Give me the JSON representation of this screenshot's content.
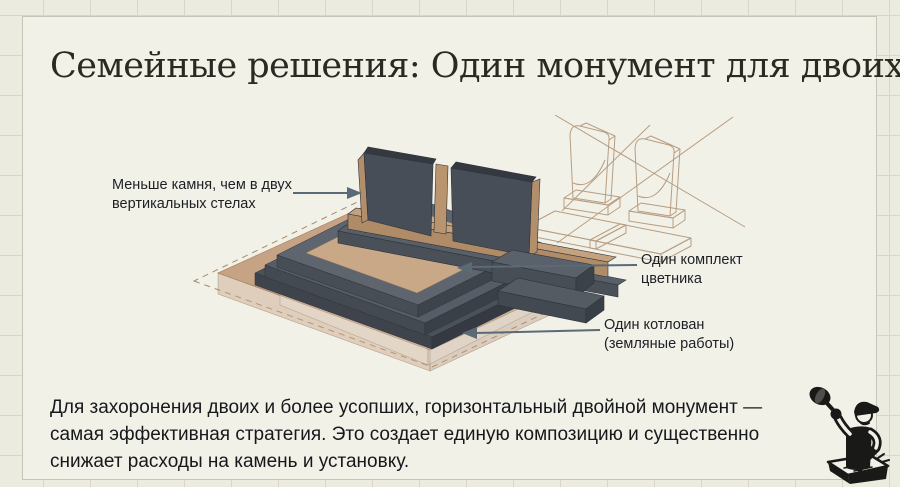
{
  "slide": {
    "title": "Семейные решения: Один монумент для двоих",
    "paragraph_lines": [
      "Для захоронения двоих и более усопших, горизонтальный двойной монумент —",
      "самая эффективная стратегия. Это создает единую композицию и существенно",
      "снижает расходы на камень и установку."
    ]
  },
  "annotations": {
    "less_stone": {
      "line1": "Меньше камня, чем в двух",
      "line2": "вертикальных стелах"
    },
    "flowerbed": {
      "line1": "Один комплект",
      "line2": "цветника"
    },
    "pit": {
      "line1": "Один котлован",
      "line2": "(земляные работы)"
    }
  },
  "icons": {
    "logo": "stonemason-carving-stone",
    "illustration": "horizontal-double-monument-isometric",
    "rejected_option": "two-vertical-steles-crossed-out"
  },
  "colors": {
    "background_grid": "#ecebdf",
    "card_background": "#f2f1e8",
    "stone_dark": "#484e57",
    "stone_face_light": "#5e656e",
    "wood_tan": "#b28e6b",
    "ground_tan": "#c7a385",
    "sketch_line": "#b79d81",
    "arrow": "#5a6a76",
    "ink": "#1c1f24"
  }
}
